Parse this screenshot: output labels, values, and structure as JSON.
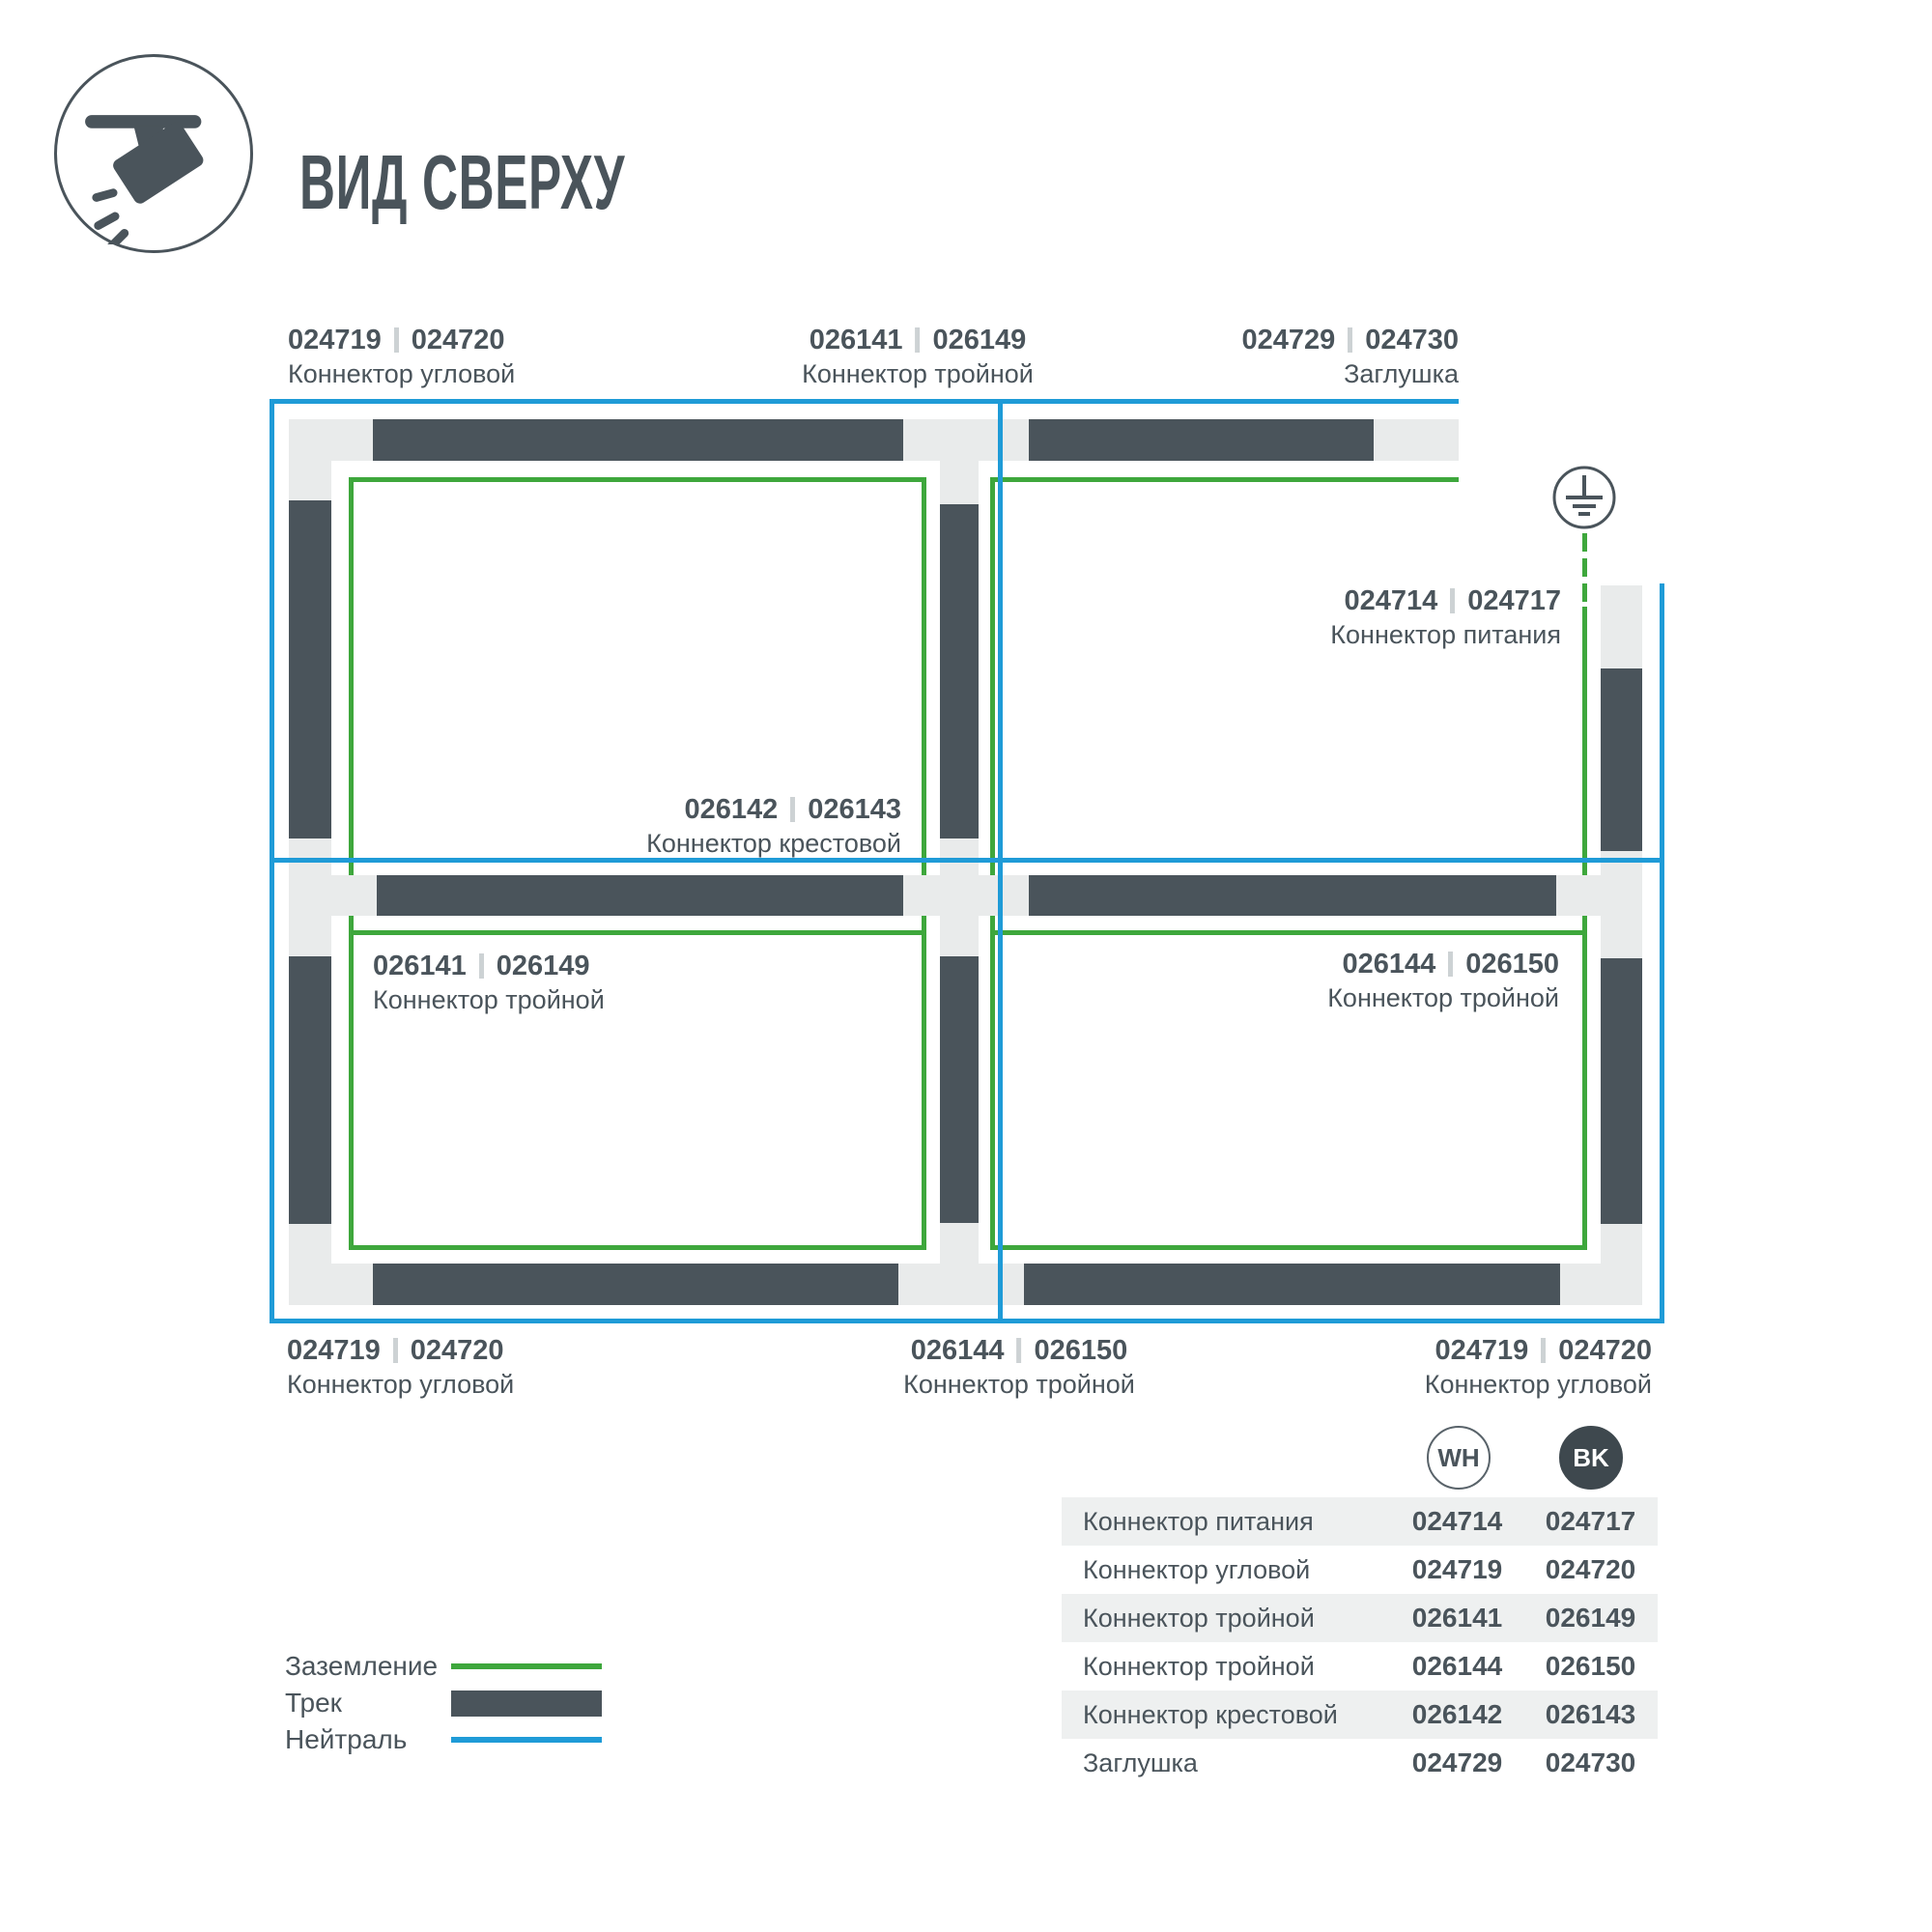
{
  "title": "ВИД СВЕРХУ",
  "colors": {
    "track": "#4A545B",
    "connector": "#E9EBEB",
    "ground": "#3EA73C",
    "neutral": "#1F9BD7",
    "table_bk_badge": "#3E484E",
    "row_alt": "#EEF0F0"
  },
  "diagram": {
    "labels": {
      "top_left": {
        "wh": "024719",
        "bk": "024720",
        "name": "Коннектор угловой"
      },
      "top_mid": {
        "wh": "026141",
        "bk": "026149",
        "name": "Коннектор тройной"
      },
      "top_right": {
        "wh": "024729",
        "bk": "024730",
        "name": "Заглушка"
      },
      "power": {
        "wh": "024714",
        "bk": "024717",
        "name": "Коннектор питания"
      },
      "center": {
        "wh": "026142",
        "bk": "026143",
        "name": "Коннектор крестовой"
      },
      "mid_left": {
        "wh": "026141",
        "bk": "026149",
        "name": "Коннектор тройной"
      },
      "mid_right": {
        "wh": "026144",
        "bk": "026150",
        "name": "Коннектор тройной"
      },
      "bottom_left": {
        "wh": "024719",
        "bk": "024720",
        "name": "Коннектор угловой"
      },
      "bottom_mid": {
        "wh": "026144",
        "bk": "026150",
        "name": "Коннектор тройной"
      },
      "bottom_right": {
        "wh": "024719",
        "bk": "024720",
        "name": "Коннектор угловой"
      }
    }
  },
  "legend": {
    "items": [
      {
        "label": "Заземление",
        "type": "ground"
      },
      {
        "label": "Трек",
        "type": "track"
      },
      {
        "label": "Нейтраль",
        "type": "neutral"
      }
    ]
  },
  "table": {
    "col_wh": "WH",
    "col_bk": "BK",
    "rows": [
      {
        "name": "Коннектор питания",
        "wh": "024714",
        "bk": "024717"
      },
      {
        "name": "Коннектор угловой",
        "wh": "024719",
        "bk": "024720"
      },
      {
        "name": "Коннектор тройной",
        "wh": "026141",
        "bk": "026149"
      },
      {
        "name": "Коннектор тройной",
        "wh": "026144",
        "bk": "026150"
      },
      {
        "name": "Коннектор крестовой",
        "wh": "026142",
        "bk": "026143"
      },
      {
        "name": "Заглушка",
        "wh": "024729",
        "bk": "024730"
      }
    ]
  }
}
